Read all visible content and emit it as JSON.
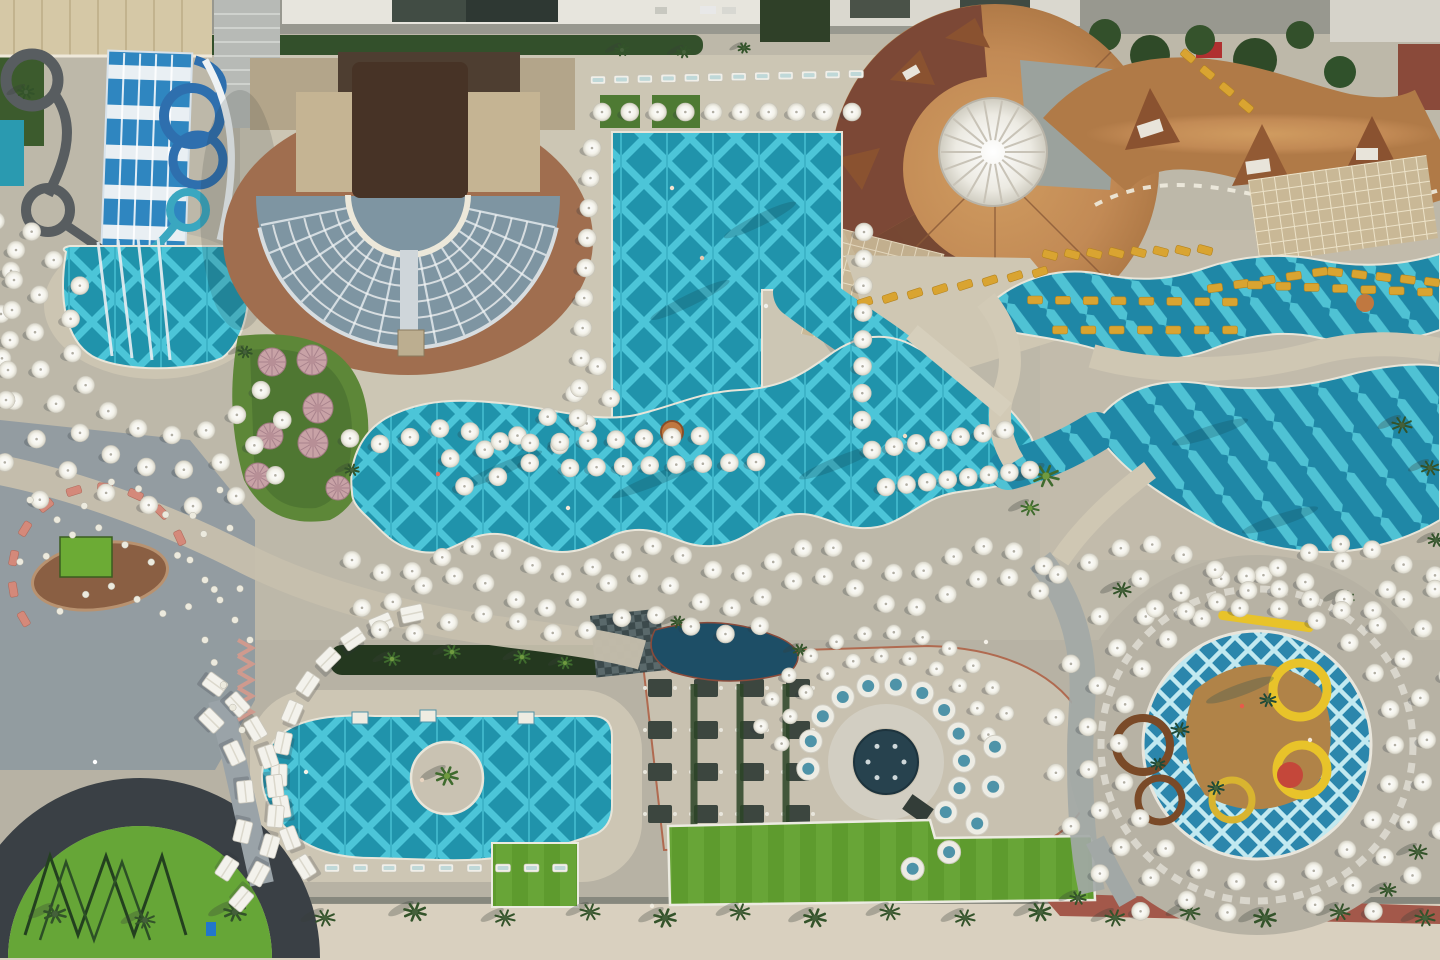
{
  "meta": {
    "type": "aerial-photograph",
    "subject": "resort hotel waterpark complex seen from directly above",
    "visible_text": []
  },
  "palette": {
    "paving": "#bdb8a9",
    "paving-warm": "#cfc8b6",
    "plaza": "#8e99a0",
    "pool-base": "#2093ab",
    "pool-stripe": "#4cc5d8",
    "kids-pool": "#2b86ac",
    "navy-pond": "#1d4e66",
    "roof-orange": "#c28a55",
    "roof-darkred": "#7c4836",
    "roof-darkbrown": "#4e3e31",
    "deck-brown": "#a06e4f",
    "seat-gray": "#7e95a2",
    "turf": "#63a032",
    "veg-dark": "#33502b",
    "umbrella": "#f3f2ec",
    "lounger-yellow": "#d9a431",
    "stage-dark": "#3a4045",
    "pink": "#d4897a",
    "sand": "#d9d0bf",
    "red-path": "#a3584a",
    "slide-blue": "#2f86c0",
    "tube-gray": "#585d60"
  },
  "scene": {
    "arcs": [
      [
        175,
        330,
        105,
        35,
        205,
        10,
        "umb"
      ],
      [
        175,
        330,
        140,
        40,
        210,
        12,
        "umb"
      ],
      [
        175,
        332,
        175,
        55,
        215,
        12,
        "umb"
      ],
      [
        178,
        335,
        215,
        130,
        212,
        7,
        "umb"
      ],
      [
        410,
        230,
        232,
        36,
        80,
        6,
        "umb"
      ],
      [
        410,
        230,
        262,
        40,
        78,
        6,
        "umb"
      ],
      [
        1257,
        745,
        138,
        0,
        345,
        22,
        "umb"
      ],
      [
        1257,
        745,
        170,
        100,
        430,
        24,
        "umb"
      ],
      [
        1257,
        745,
        203,
        125,
        235,
        8,
        "umb"
      ],
      [
        1257,
        745,
        203,
        295,
        415,
        9,
        "umb"
      ],
      [
        886,
        762,
        106,
        190,
        345,
        11,
        "umbS"
      ],
      [
        886,
        762,
        130,
        196,
        338,
        12,
        "umbS"
      ],
      [
        886,
        762,
        78,
        175,
        400,
        12,
        "booth"
      ],
      [
        886,
        762,
        110,
        352,
        436,
        5,
        "booth"
      ],
      [
        447,
        778,
        168,
        148,
        258,
        11,
        "sq"
      ],
      [
        128,
        804,
        148,
        306,
        400,
        9,
        "sq"
      ],
      [
        128,
        804,
        118,
        315,
        393,
        5,
        "sq"
      ],
      [
        100,
        575,
        88,
        150,
        335,
        10,
        "pink"
      ]
    ],
    "waves": [
      [
        352,
        1044,
        24,
        560,
        14,
        170,
        0,
        "umb"
      ],
      [
        362,
        1040,
        23,
        592,
        16,
        180,
        1.4,
        "umb"
      ],
      [
        380,
        760,
        12,
        624,
        10,
        160,
        0.6,
        "umb"
      ],
      [
        350,
        530,
        7,
        436,
        8,
        140,
        0.3,
        "umb"
      ],
      [
        1058,
        1435,
        13,
        560,
        16,
        200,
        2.0,
        "umb"
      ],
      [
        1155,
        1435,
        10,
        600,
        12,
        180,
        0.8,
        "umb"
      ],
      [
        30,
        220,
        8,
        500,
        20,
        120,
        0,
        "table"
      ],
      [
        20,
        230,
        9,
        545,
        18,
        130,
        1.2,
        "table"
      ],
      [
        60,
        240,
        8,
        600,
        14,
        120,
        2.2,
        "table"
      ]
    ],
    "rows": [
      [
        602,
        112,
        852,
        112,
        10,
        "umb",
        0
      ],
      [
        592,
        148,
        578,
        418,
        10,
        "umb",
        0
      ],
      [
        864,
        232,
        862,
        420,
        8,
        "umb",
        0
      ],
      [
        560,
        442,
        700,
        436,
        6,
        "umb",
        0
      ],
      [
        570,
        468,
        756,
        462,
        8,
        "umb",
        0
      ],
      [
        872,
        450,
        1005,
        430,
        7,
        "umb",
        0
      ],
      [
        886,
        487,
        1030,
        470,
        8,
        "umb",
        0
      ],
      [
        16,
        250,
        6,
        400,
        6,
        "umb",
        0
      ],
      [
        598,
        80,
        856,
        74,
        12,
        "wlounger",
        0
      ],
      [
        332,
        868,
        560,
        868,
        9,
        "wlounger",
        0
      ],
      [
        1050,
        255,
        1205,
        250,
        8,
        "ylounger",
        15
      ],
      [
        865,
        302,
        1040,
        272,
        8,
        "ylounger",
        -18
      ],
      [
        1215,
        288,
        1320,
        272,
        5,
        "ylounger",
        -8
      ],
      [
        1335,
        272,
        1432,
        282,
        5,
        "ylounger",
        8
      ],
      [
        1035,
        300,
        1230,
        302,
        8,
        "ylounger",
        0
      ],
      [
        1060,
        330,
        1230,
        330,
        7,
        "ylounger",
        0
      ],
      [
        1255,
        285,
        1425,
        292,
        7,
        "ylounger",
        0
      ],
      [
        1188,
        56,
        1246,
        106,
        4,
        "ylounger",
        40
      ],
      [
        205,
        640,
        242,
        730,
        5,
        "table",
        0
      ],
      [
        190,
        560,
        250,
        640,
        5,
        "table",
        0
      ]
    ],
    "palms": [
      [
        55,
        914,
        11,
        0
      ],
      [
        145,
        920,
        10,
        0
      ],
      [
        235,
        912,
        11,
        0
      ],
      [
        325,
        918,
        10,
        0
      ],
      [
        415,
        912,
        11,
        0
      ],
      [
        505,
        918,
        10,
        0
      ],
      [
        590,
        912,
        10,
        0
      ],
      [
        665,
        918,
        11,
        0
      ],
      [
        740,
        912,
        10,
        0
      ],
      [
        815,
        918,
        11,
        0
      ],
      [
        890,
        912,
        10,
        0
      ],
      [
        965,
        918,
        10,
        0
      ],
      [
        1040,
        912,
        11,
        0
      ],
      [
        1115,
        918,
        10,
        0
      ],
      [
        1190,
        912,
        10,
        0
      ],
      [
        1265,
        918,
        11,
        0
      ],
      [
        1340,
        912,
        10,
        0
      ],
      [
        1425,
        918,
        10,
        0
      ],
      [
        447,
        776,
        11,
        1
      ],
      [
        392,
        659,
        8,
        1
      ],
      [
        452,
        652,
        8,
        1
      ],
      [
        522,
        657,
        8,
        1
      ],
      [
        565,
        663,
        7,
        1
      ],
      [
        1046,
        476,
        13,
        1
      ],
      [
        1030,
        508,
        9,
        1
      ],
      [
        1180,
        730,
        9,
        2
      ],
      [
        1216,
        788,
        8,
        2
      ],
      [
        1268,
        700,
        8,
        2
      ],
      [
        1158,
        764,
        7,
        2
      ],
      [
        1122,
        590,
        9,
        0
      ],
      [
        1345,
        598,
        9,
        0
      ],
      [
        1418,
        852,
        9,
        0
      ],
      [
        1388,
        890,
        8,
        0
      ],
      [
        1078,
        898,
        8,
        0
      ],
      [
        1402,
        425,
        10,
        0
      ],
      [
        1430,
        468,
        9,
        0
      ],
      [
        1436,
        540,
        8,
        0
      ],
      [
        678,
        622,
        7,
        0
      ],
      [
        800,
        650,
        7,
        0
      ],
      [
        622,
        50,
        7,
        0
      ],
      [
        684,
        52,
        7,
        0
      ],
      [
        744,
        48,
        6,
        0
      ],
      [
        245,
        352,
        7,
        0
      ],
      [
        352,
        470,
        7,
        0
      ],
      [
        26,
        92,
        8,
        0
      ]
    ],
    "palm_shadows": [
      [
        500,
        470,
        -24,
        46
      ],
      [
        660,
        478,
        -22,
        52
      ],
      [
        840,
        462,
        -22,
        44
      ],
      [
        1210,
        432,
        -18,
        40
      ],
      [
        1280,
        520,
        -18,
        40
      ],
      [
        690,
        300,
        -26,
        44
      ],
      [
        760,
        220,
        -26,
        40
      ],
      [
        1240,
        690,
        -20,
        36
      ]
    ],
    "domes": [
      [
        272,
        362,
        14
      ],
      [
        312,
        360,
        15
      ],
      [
        318,
        408,
        15
      ],
      [
        270,
        436,
        13
      ],
      [
        313,
        443,
        15
      ],
      [
        258,
        476,
        13
      ],
      [
        338,
        488,
        12
      ]
    ],
    "people": [
      [
        672,
        188,
        "#f4e3d0"
      ],
      [
        702,
        258,
        "#e8c9b0"
      ],
      [
        766,
        306,
        "#f0f0ea"
      ],
      [
        438,
        474,
        "#e86858"
      ],
      [
        568,
        508,
        "#f4e8d8"
      ],
      [
        905,
        436,
        "#f0ddc8"
      ],
      [
        1242,
        706,
        "#e85a4a"
      ],
      [
        1185,
        762,
        "#f2e6d4"
      ],
      [
        306,
        772,
        "#f4f0e6"
      ],
      [
        95,
        762,
        "#ffffff"
      ],
      [
        652,
        906,
        "#f0ece0"
      ],
      [
        986,
        642,
        "#f4f0e8"
      ],
      [
        422,
        780,
        "#e8d4c0"
      ],
      [
        1310,
        740,
        "#f4e9d9"
      ]
    ],
    "dark_tables": {
      "cols": [
        660,
        706,
        752,
        798
      ],
      "rows": [
        688,
        730,
        772,
        814
      ]
    },
    "zigzag": {
      "x": 238,
      "y0": 640,
      "n": 5,
      "step": 16
    }
  }
}
